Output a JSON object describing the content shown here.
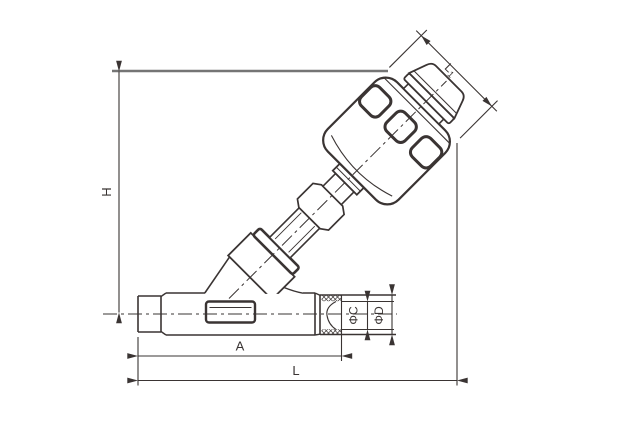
{
  "drawing": {
    "title": "angle-seat-valve-dimension-drawing",
    "dimension_labels": {
      "height": "H",
      "body_length": "A",
      "overall_length": "L",
      "actuator_diameter_main": "L",
      "actuator_diameter_sub": "1",
      "port_bore_diameter": "ΦC",
      "port_outer_diameter": "ΦD"
    }
  },
  "colors": {
    "line": "#3a3433",
    "extension_line": "#757575",
    "background": "#ffffff"
  }
}
